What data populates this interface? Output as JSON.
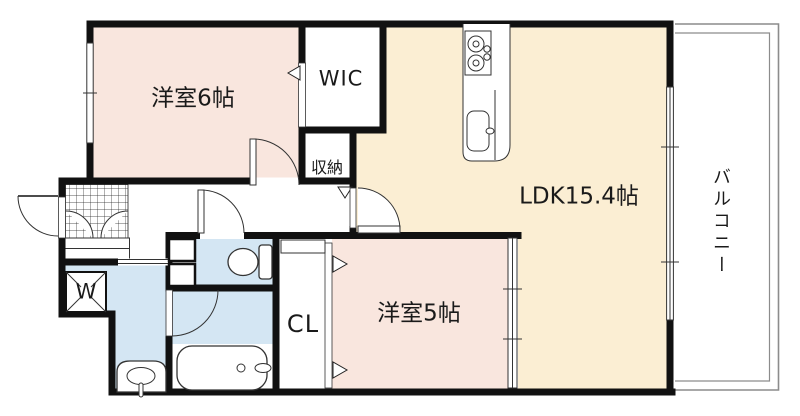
{
  "floorplan": {
    "title": "apartment-floor-plan",
    "rooms": {
      "bedroom6": {
        "label": "洋室6帖"
      },
      "wic": {
        "label": "WIC"
      },
      "storage": {
        "label": "収納"
      },
      "ldk": {
        "label": "LDK15.4帖"
      },
      "bedroom5": {
        "label": "洋室5帖"
      },
      "closet": {
        "label": "CL"
      },
      "laundry": {
        "label": "W"
      },
      "balcony": {
        "label": "バルコニー"
      }
    },
    "colors": {
      "room_pink": "#F9E6DE",
      "ldk_cream": "#FBEED3",
      "wet_blue": "#D4E6F3",
      "wall": "#111111",
      "balcony_line": "#8C8C8C"
    }
  }
}
